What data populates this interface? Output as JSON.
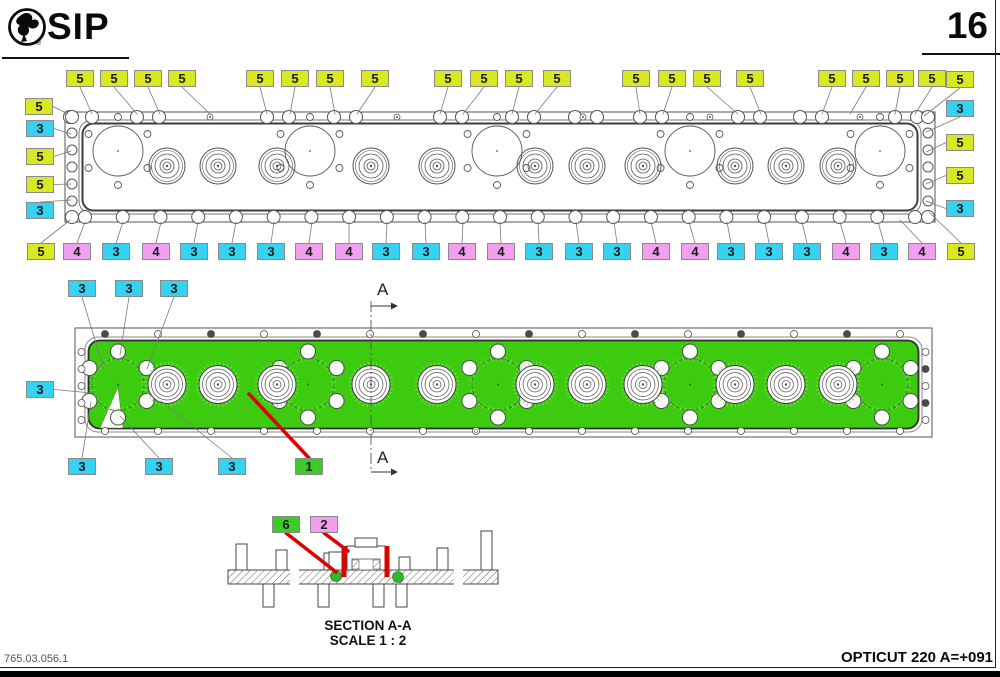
{
  "header": {
    "brand": "SIP",
    "page": "16"
  },
  "footer": {
    "left": "765.03.056.1",
    "right": "OPTICUT 220 A=+091"
  },
  "section_view": {
    "title": "SECTION A-A",
    "scale": "SCALE 1 : 2"
  },
  "section_mark": {
    "letter": "A"
  },
  "colors": {
    "yellow": "#d9e821",
    "cyan": "#35d2f2",
    "pink": "#f0a0ef",
    "green": "#3ecb2a",
    "bar_green": "#3ccb0f",
    "red": "#dd0000",
    "leader": "#7a7a7a",
    "line": "#555555"
  },
  "callouts": [
    {
      "text": "5",
      "color": "yellow",
      "x": 66,
      "y": 70,
      "tx": 92,
      "ty": 114
    },
    {
      "text": "5",
      "color": "yellow",
      "x": 100,
      "y": 70,
      "tx": 137,
      "ty": 114
    },
    {
      "text": "5",
      "color": "yellow",
      "x": 134,
      "y": 70,
      "tx": 160,
      "ty": 114
    },
    {
      "text": "5",
      "color": "yellow",
      "x": 168,
      "y": 70,
      "tx": 210,
      "ty": 114
    },
    {
      "text": "5",
      "color": "yellow",
      "x": 246,
      "y": 70,
      "tx": 267,
      "ty": 114
    },
    {
      "text": "5",
      "color": "yellow",
      "x": 281,
      "y": 70,
      "tx": 290,
      "ty": 114
    },
    {
      "text": "5",
      "color": "yellow",
      "x": 316,
      "y": 70,
      "tx": 335,
      "ty": 114
    },
    {
      "text": "5",
      "color": "yellow",
      "x": 361,
      "y": 70,
      "tx": 357,
      "ty": 114
    },
    {
      "text": "5",
      "color": "yellow",
      "x": 434,
      "y": 70,
      "tx": 440,
      "ty": 114
    },
    {
      "text": "5",
      "color": "yellow",
      "x": 470,
      "y": 70,
      "tx": 463,
      "ty": 114
    },
    {
      "text": "5",
      "color": "yellow",
      "x": 505,
      "y": 70,
      "tx": 512,
      "ty": 114
    },
    {
      "text": "5",
      "color": "yellow",
      "x": 543,
      "y": 70,
      "tx": 535,
      "ty": 114
    },
    {
      "text": "5",
      "color": "yellow",
      "x": 622,
      "y": 70,
      "tx": 640,
      "ty": 114
    },
    {
      "text": "5",
      "color": "yellow",
      "x": 658,
      "y": 70,
      "tx": 663,
      "ty": 114
    },
    {
      "text": "5",
      "color": "yellow",
      "x": 693,
      "y": 70,
      "tx": 738,
      "ty": 114
    },
    {
      "text": "5",
      "color": "yellow",
      "x": 736,
      "y": 70,
      "tx": 761,
      "ty": 114
    },
    {
      "text": "5",
      "color": "yellow",
      "x": 818,
      "y": 70,
      "tx": 822,
      "ty": 114
    },
    {
      "text": "5",
      "color": "yellow",
      "x": 852,
      "y": 70,
      "tx": 850,
      "ty": 114
    },
    {
      "text": "5",
      "color": "yellow",
      "x": 886,
      "y": 70,
      "tx": 895,
      "ty": 114
    },
    {
      "text": "5",
      "color": "yellow",
      "x": 918,
      "y": 70,
      "tx": 915,
      "ty": 114
    },
    {
      "text": "5",
      "color": "yellow",
      "x": 25,
      "y": 98,
      "tx": 68,
      "ty": 114
    },
    {
      "text": "5",
      "color": "yellow",
      "x": 946,
      "y": 71,
      "tx": 924,
      "ty": 116
    },
    {
      "text": "3",
      "color": "cyan",
      "x": 26,
      "y": 120,
      "tx": 71,
      "ty": 134
    },
    {
      "text": "5",
      "color": "yellow",
      "x": 26,
      "y": 148,
      "tx": 71,
      "ty": 151
    },
    {
      "text": "5",
      "color": "yellow",
      "x": 26,
      "y": 176,
      "tx": 71,
      "ty": 184
    },
    {
      "text": "3",
      "color": "cyan",
      "x": 26,
      "y": 202,
      "tx": 71,
      "ty": 200
    },
    {
      "text": "3",
      "color": "cyan",
      "x": 946,
      "y": 100,
      "tx": 926,
      "ty": 132
    },
    {
      "text": "5",
      "color": "yellow",
      "x": 946,
      "y": 134,
      "tx": 926,
      "ty": 152
    },
    {
      "text": "5",
      "color": "yellow",
      "x": 946,
      "y": 167,
      "tx": 926,
      "ty": 184
    },
    {
      "text": "3",
      "color": "cyan",
      "x": 946,
      "y": 200,
      "tx": 926,
      "ty": 201
    },
    {
      "text": "5",
      "color": "yellow",
      "x": 27,
      "y": 243,
      "tx": 70,
      "ty": 220
    },
    {
      "text": "4",
      "color": "pink",
      "x": 63,
      "y": 243,
      "tx": 85,
      "ty": 222
    },
    {
      "text": "3",
      "color": "cyan",
      "x": 102,
      "y": 243,
      "tx": 123,
      "ty": 222
    },
    {
      "text": "4",
      "color": "pink",
      "x": 142,
      "y": 243,
      "tx": 161,
      "ty": 222
    },
    {
      "text": "3",
      "color": "cyan",
      "x": 180,
      "y": 243,
      "tx": 198,
      "ty": 222
    },
    {
      "text": "3",
      "color": "cyan",
      "x": 218,
      "y": 243,
      "tx": 236,
      "ty": 222
    },
    {
      "text": "3",
      "color": "cyan",
      "x": 257,
      "y": 243,
      "tx": 274,
      "ty": 222
    },
    {
      "text": "4",
      "color": "pink",
      "x": 295,
      "y": 243,
      "tx": 312,
      "ty": 222
    },
    {
      "text": "4",
      "color": "pink",
      "x": 335,
      "y": 243,
      "tx": 349,
      "ty": 222
    },
    {
      "text": "3",
      "color": "cyan",
      "x": 372,
      "y": 243,
      "tx": 387,
      "ty": 222
    },
    {
      "text": "3",
      "color": "cyan",
      "x": 412,
      "y": 243,
      "tx": 425,
      "ty": 222
    },
    {
      "text": "4",
      "color": "pink",
      "x": 448,
      "y": 243,
      "tx": 463,
      "ty": 222
    },
    {
      "text": "4",
      "color": "pink",
      "x": 487,
      "y": 243,
      "tx": 500,
      "ty": 222
    },
    {
      "text": "3",
      "color": "cyan",
      "x": 525,
      "y": 243,
      "tx": 538,
      "ty": 222
    },
    {
      "text": "3",
      "color": "cyan",
      "x": 565,
      "y": 243,
      "tx": 576,
      "ty": 222
    },
    {
      "text": "3",
      "color": "cyan",
      "x": 603,
      "y": 243,
      "tx": 614,
      "ty": 222
    },
    {
      "text": "4",
      "color": "pink",
      "x": 642,
      "y": 243,
      "tx": 651,
      "ty": 222
    },
    {
      "text": "4",
      "color": "pink",
      "x": 681,
      "y": 243,
      "tx": 689,
      "ty": 222
    },
    {
      "text": "3",
      "color": "cyan",
      "x": 717,
      "y": 243,
      "tx": 727,
      "ty": 222
    },
    {
      "text": "3",
      "color": "cyan",
      "x": 755,
      "y": 243,
      "tx": 765,
      "ty": 222
    },
    {
      "text": "3",
      "color": "cyan",
      "x": 793,
      "y": 243,
      "tx": 802,
      "ty": 222
    },
    {
      "text": "4",
      "color": "pink",
      "x": 832,
      "y": 243,
      "tx": 840,
      "ty": 222
    },
    {
      "text": "3",
      "color": "cyan",
      "x": 870,
      "y": 243,
      "tx": 878,
      "ty": 222
    },
    {
      "text": "4",
      "color": "pink",
      "x": 908,
      "y": 243,
      "tx": 900,
      "ty": 220
    },
    {
      "text": "5",
      "color": "yellow",
      "x": 947,
      "y": 243,
      "tx": 929,
      "ty": 212
    },
    {
      "text": "3",
      "color": "cyan",
      "x": 68,
      "y": 280,
      "tx": 104,
      "ty": 370
    },
    {
      "text": "3",
      "color": "cyan",
      "x": 115,
      "y": 280,
      "tx": 120,
      "ty": 355
    },
    {
      "text": "3",
      "color": "cyan",
      "x": 160,
      "y": 280,
      "tx": 147,
      "ty": 369
    },
    {
      "text": "3",
      "color": "cyan",
      "x": 26,
      "y": 381,
      "tx": 92,
      "ty": 393
    },
    {
      "text": "3",
      "color": "cyan",
      "x": 68,
      "y": 458,
      "tx": 91,
      "ty": 402
    },
    {
      "text": "3",
      "color": "cyan",
      "x": 145,
      "y": 458,
      "tx": 120,
      "ty": 416
    },
    {
      "text": "3",
      "color": "cyan",
      "x": 218,
      "y": 458,
      "tx": 161,
      "ty": 401
    },
    {
      "text": "1",
      "color": "green",
      "x": 295,
      "y": 458,
      "tx": 249,
      "ty": 394,
      "red": true
    },
    {
      "text": "6",
      "color": "green",
      "x": 272,
      "y": 516,
      "tx": 336,
      "ty": 572,
      "red": true
    },
    {
      "text": "2",
      "color": "pink",
      "x": 310,
      "y": 516,
      "tx": 348,
      "ty": 551,
      "red": true
    }
  ]
}
